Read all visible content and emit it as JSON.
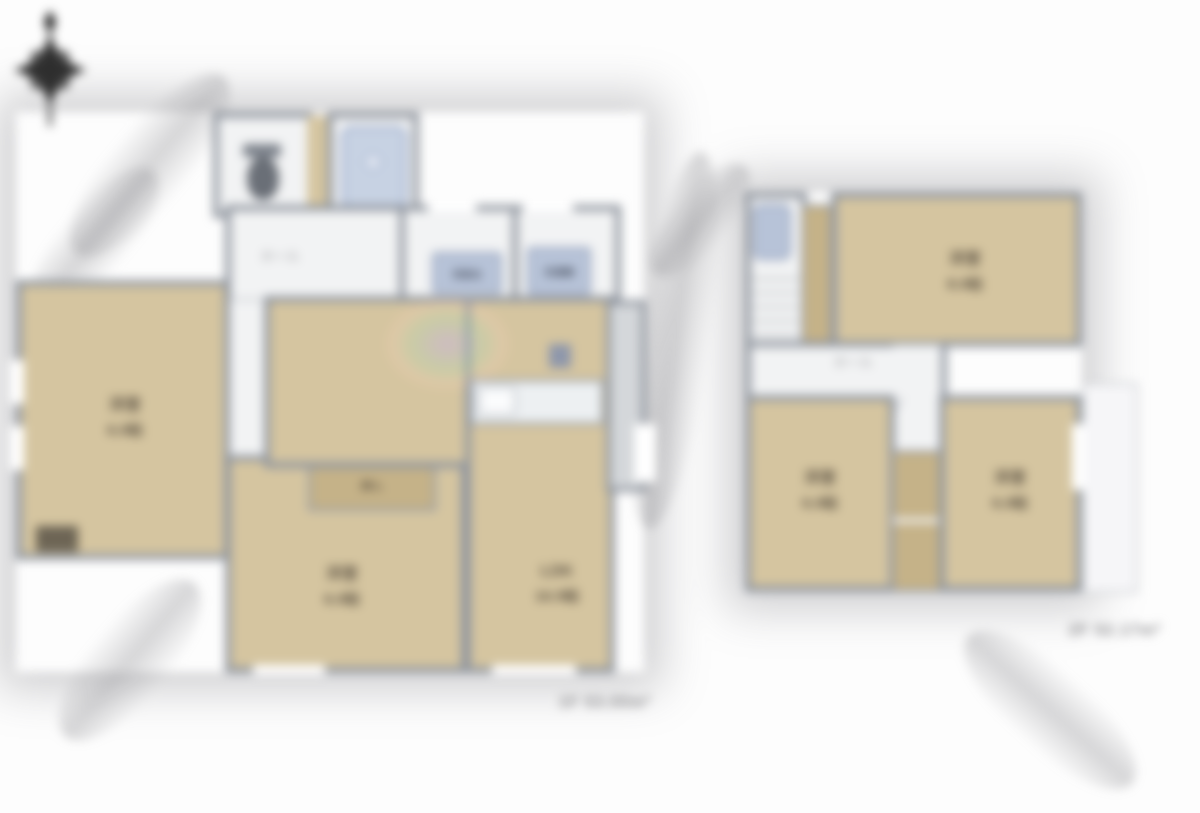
{
  "floor1": {
    "caption": "1F 53.00m²",
    "hall_label": "ホール",
    "bedroom_left": {
      "name": "洋室",
      "size": "6.0帖"
    },
    "bedroom_center": {
      "name": "洋室",
      "size": "6.0帖"
    },
    "ldk": {
      "name": "LDK",
      "size": "16.5帖"
    },
    "closet_label": "押入",
    "vanity_label": "洗面台",
    "washer_label": "洗濯機"
  },
  "floor2": {
    "caption": "2F 52.17m²",
    "hall_label": "ホール",
    "bedroom_top": {
      "name": "洋室",
      "size": "8.0帖"
    },
    "bedroom_left": {
      "name": "洋室",
      "size": "6.0帖"
    },
    "bedroom_right": {
      "name": "洋室",
      "size": "6.0帖"
    }
  },
  "colors": {
    "floor_tan": "#d5c5a0",
    "closet_tan": "#c5b288",
    "wall_gray": "#8f959e",
    "fixture_blue": "#b7c3d8",
    "bath_blue": "#c7d2e3",
    "label_dark": "#5f5546",
    "caption_gray": "#8b8b8e",
    "background": "#ffffff"
  }
}
